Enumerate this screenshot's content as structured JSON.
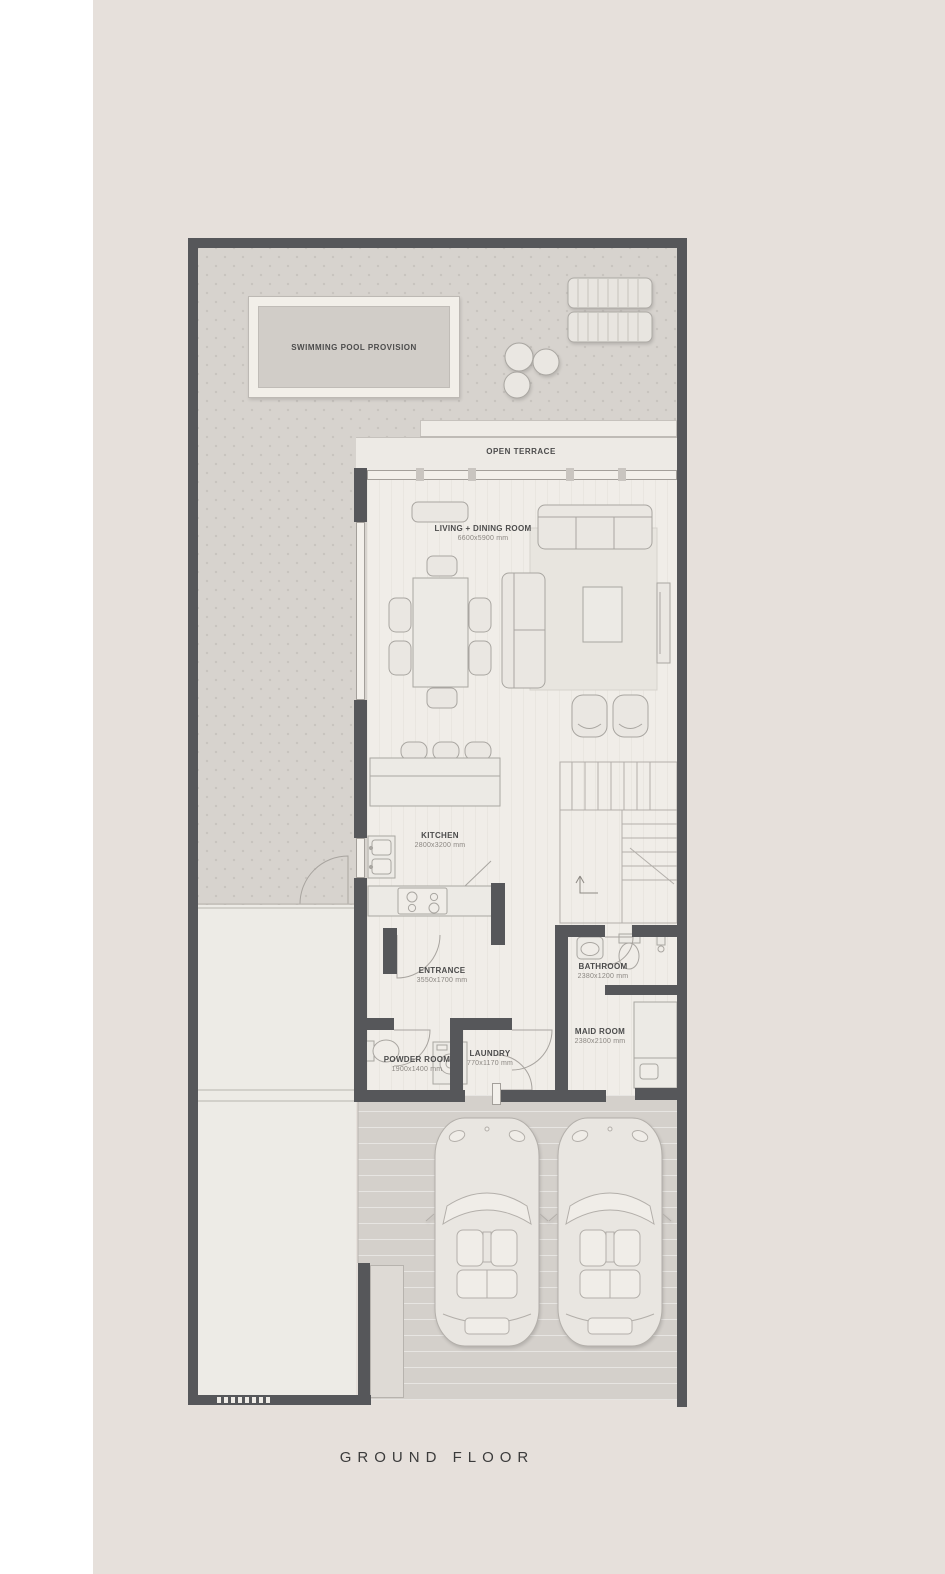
{
  "title": "GROUND FLOOR",
  "outdoor": {
    "pool": "SWIMMING POOL PROVISION",
    "terrace": "OPEN TERRACE"
  },
  "rooms": [
    {
      "id": "living",
      "name": "LIVING + DINING ROOM",
      "dims": "6600x5900 mm"
    },
    {
      "id": "kitchen",
      "name": "KITCHEN",
      "dims": "2800x3200 mm"
    },
    {
      "id": "entrance",
      "name": "ENTRANCE",
      "dims": "3550x1700 mm"
    },
    {
      "id": "bathroom",
      "name": "BATHROOM",
      "dims": "2380x1200 mm"
    },
    {
      "id": "maid",
      "name": "MAID ROOM",
      "dims": "2380x2100 mm"
    },
    {
      "id": "powder",
      "name": "POWDER ROOM",
      "dims": "1900x1400 mm"
    },
    {
      "id": "laundry",
      "name": "LAUNDRY",
      "dims": "770x1170 mm"
    }
  ],
  "colors": {
    "page_background": "#e6e0db",
    "left_strip": "#ffffff",
    "wall": "#56575a",
    "garden": "#d7d3ce",
    "interior_floor": "#f0ede8",
    "garage_floor": "#d4d0cb",
    "label_text": "#4c4c4c",
    "dims_text": "#8b8782",
    "title_text": "#3c3c3c"
  }
}
